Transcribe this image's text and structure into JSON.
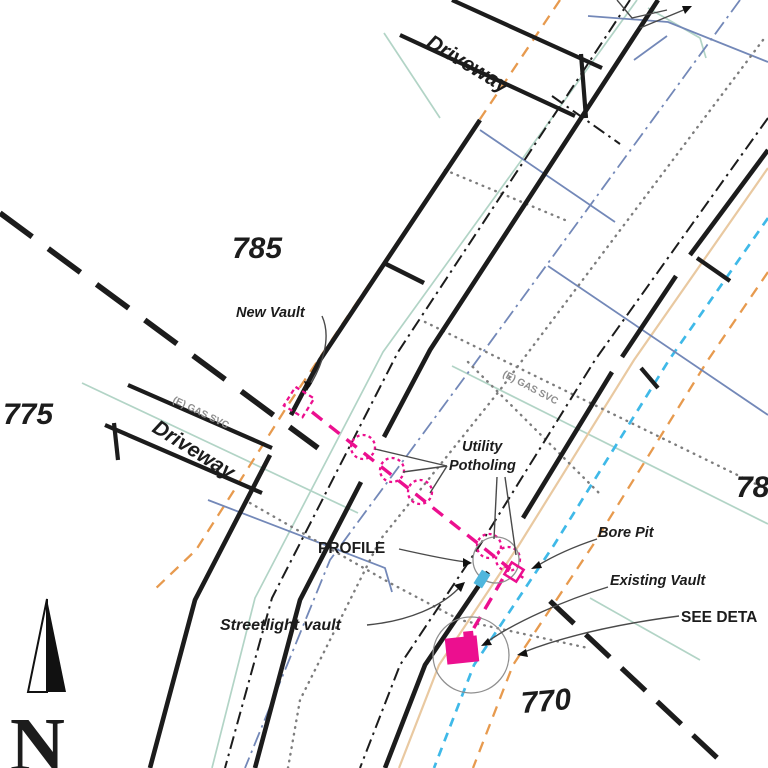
{
  "plan": {
    "stations": {
      "s785": "785",
      "s775": "775",
      "s780_clipped": "78",
      "s770": "770"
    },
    "streets": {
      "driveway_top": "Driveway",
      "driveway_left": "Driveway"
    },
    "utilities": {
      "gas_left": "(E) GAS SVC",
      "gas_right": "(E) GAS SVC"
    },
    "callouts": {
      "new_vault": "New Vault",
      "potholing_line1": "Utility",
      "potholing_line2": "Potholing",
      "profile": "PROFILE",
      "streetlight_vault": "Streetlight vault",
      "bore_pit": "Bore Pit",
      "existing_vault": "Existing Vault",
      "see_detail_clipped": "SEE DETA"
    },
    "north_arrow": {
      "letter": "N"
    },
    "colors": {
      "line_black": "#1c1c1c",
      "leader_gray": "#4a4a4a",
      "dotted_gray": "#7d7d7d",
      "gas_text_gray": "#8d8d8d",
      "teal_utility": "#b2d4c6",
      "tan_utility": "#e9c9a1",
      "orange_dashed": "#e79a4e",
      "cyan_dashed": "#3fb9e8",
      "slate_blue": "#7388b8",
      "magenta_bore": "#ec0f8f",
      "streetlight_vault_blue": "#4fb6dd"
    }
  }
}
